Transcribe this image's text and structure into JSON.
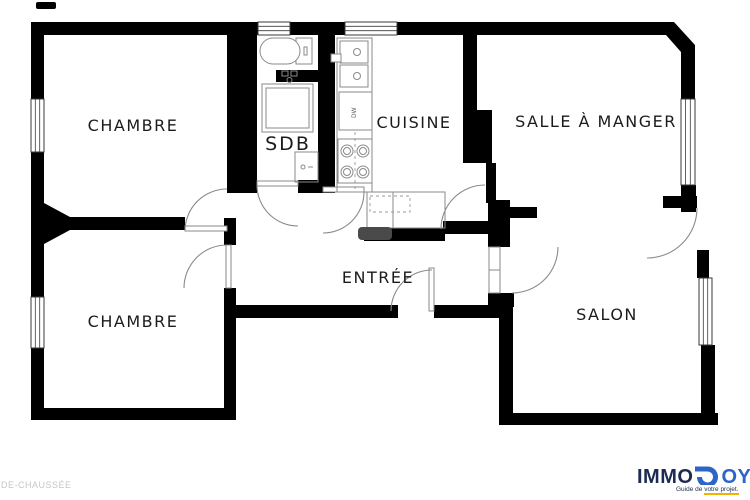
{
  "plan": {
    "floor_label": "DE-CHAUSSÉE",
    "rooms": {
      "chambre1": "CHAMBRE",
      "sdb": "SDB",
      "cuisine": "CUISINE",
      "salle_a_manger": "SALLE À MANGER",
      "chambre2": "CHAMBRE",
      "entree": "ENTRÉE",
      "salon": "SALON"
    },
    "appliances": {
      "dishwasher": "DW"
    },
    "colors": {
      "wall": "#000000",
      "fixture_line": "#8a8a8a",
      "label_text": "#1b1b1b",
      "floor_label_gray": "#c6c6c6",
      "radiator_gray": "#4a4a4a"
    }
  },
  "branding": {
    "logo_left": "IMMO",
    "logo_right": "OYEN",
    "tagline_prefix": "Guide de ",
    "tagline_highlight": "votre projet.",
    "colors": {
      "navy": "#1c2b52",
      "blue": "#2d64c8",
      "accent_yellow": "#f0b400"
    }
  }
}
